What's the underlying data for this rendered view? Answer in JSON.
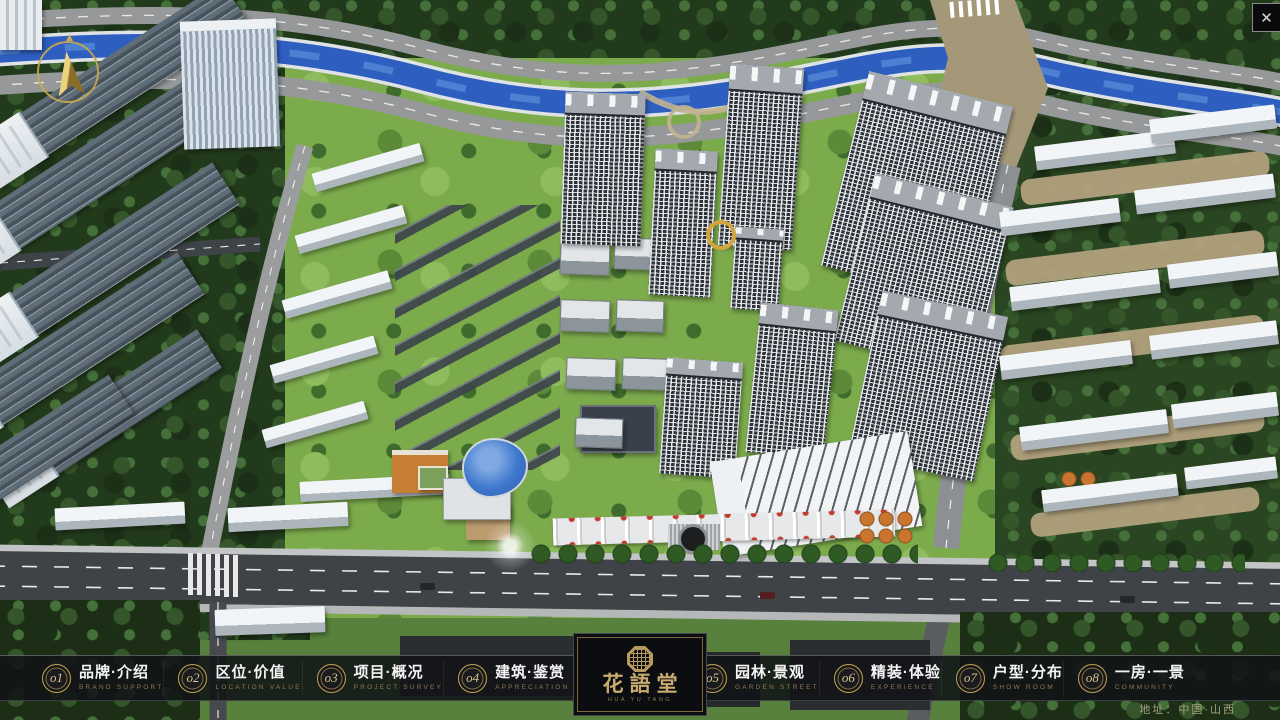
{
  "app": {
    "type": "real-estate-presentation",
    "close_glyph": "✕"
  },
  "colors": {
    "nav_bg": "rgba(17,19,23,0.88)",
    "gold": "#c3a050",
    "gold_dim": "#8d7b4e",
    "label_white": "#f4f4f4",
    "river_blue": "#2e5fc0",
    "lawn_green": "#7cab4c",
    "tree_dark": "#223a1c",
    "road_gray": "#96989a",
    "main_road_dark": "#3f4347"
  },
  "nav": {
    "items": [
      {
        "num": "o1",
        "zh": "品牌·介绍",
        "en": "BRAND SUPPORT"
      },
      {
        "num": "o2",
        "zh": "区位·价值",
        "en": "LOCATION VALUE"
      },
      {
        "num": "o3",
        "zh": "项目·概况",
        "en": "PROJECT SURVEY"
      },
      {
        "num": "o4",
        "zh": "建筑·鉴赏",
        "en": "APPRECIATION"
      },
      {
        "num": "o5",
        "zh": "园林·景观",
        "en": "GARDEN STREET"
      },
      {
        "num": "o6",
        "zh": "精装·体验",
        "en": "EXPERIENCE"
      },
      {
        "num": "o7",
        "zh": "户型·分布",
        "en": "SHOW ROOM"
      },
      {
        "num": "o8",
        "zh": "一房·一景",
        "en": "COMMUNITY"
      }
    ]
  },
  "logo": {
    "title": "花語堂",
    "caption": "HUA YU TANG"
  },
  "footer": {
    "address": "地址：中国·山西"
  },
  "icons": {
    "compass": "north-arrow",
    "close": "✕",
    "seal": "octagon-brand-seal"
  }
}
